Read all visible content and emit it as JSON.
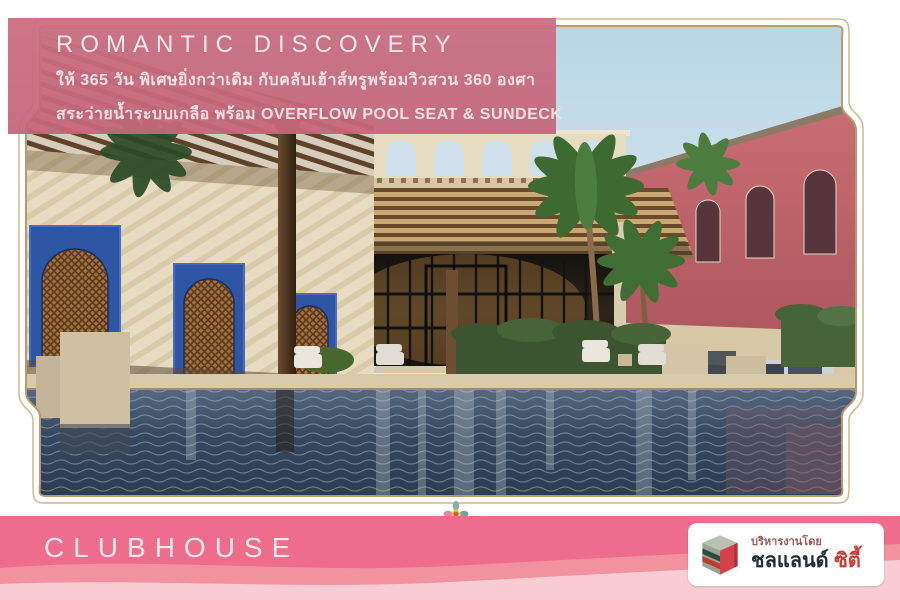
{
  "banner": {
    "title": "ROMANTIC  DISCOVERY",
    "line1": "ให้ 365 วัน พิเศษยิ่งกว่าเดิม กับคลับเฮ้าส์หรูพร้อมวิวสวน 360 องศา",
    "line2": "สระว่ายน้ำระบบเกลือ พร้อม OVERFLOW POOL SEAT & SUNDECK"
  },
  "photo": {
    "description": "Architectural rendering of a Moroccan-style clubhouse courtyard: salt-water overflow swimming pool with sundeck, wooden pergolas, cream stone walls with blue arched lattice windows, arched parapet pavilion, palm trees, and pink two-storey townhouses with parked cars"
  },
  "footer": {
    "title": "CLUBHOUSE",
    "logo": {
      "tagline": "บริหารงานโดย",
      "brand_primary": "ชลแลนด์",
      "brand_secondary": "ซิตี้"
    }
  },
  "colors": {
    "banner_pink": "#cb6e81",
    "footer_pink": "#ee6d8c",
    "footer_wave_mid": "#f2919f",
    "footer_wave_light": "#f9ccd3",
    "frame_outline": "#b89a6e",
    "logo_red": "#d6404a",
    "brand_dark": "#232c38",
    "brand_red": "#d03a35",
    "pool_blue": "#33435a",
    "window_blue": "#2f55a5"
  }
}
